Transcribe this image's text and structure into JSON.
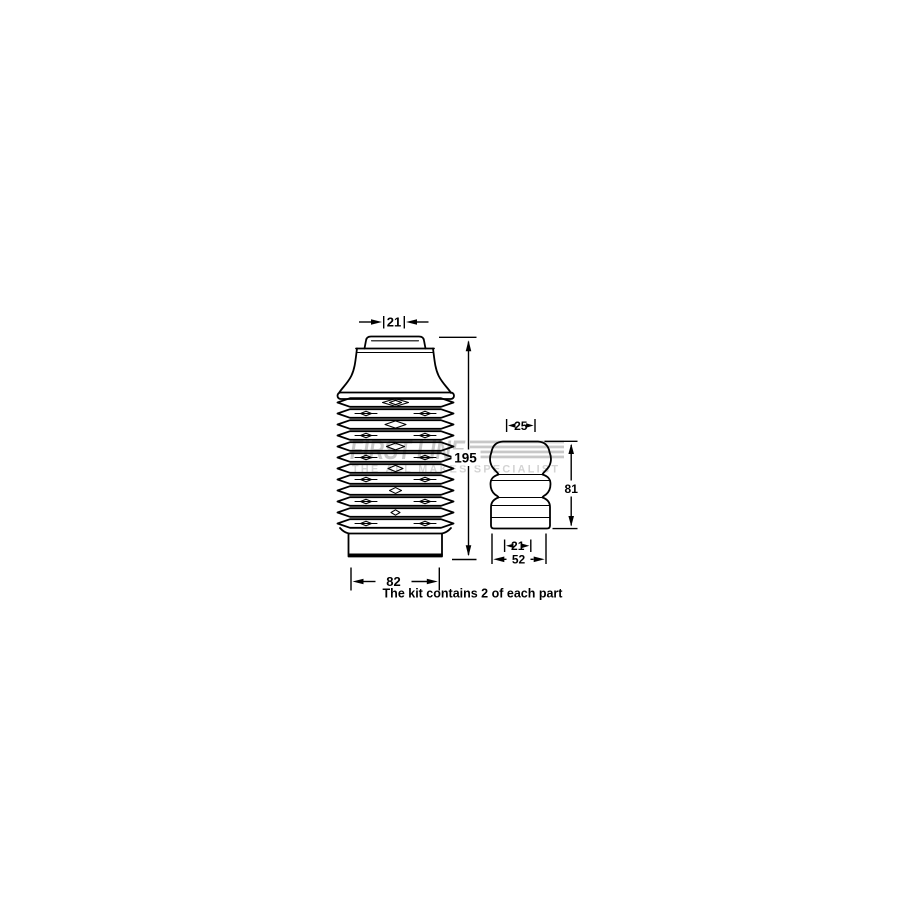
{
  "illustration": {
    "note": "The kit contains 2 of each part",
    "watermark": {
      "brand": "FIRST LINE",
      "tagline": "THE ALL MAKES SPECIALIST",
      "brand_color": "#c8c8c8",
      "tagline_color": "#d3d3d3"
    },
    "colors": {
      "line": "#000000",
      "background": "#ffffff"
    },
    "dimensions": {
      "boot_top_width": "21",
      "boot_height": "195",
      "boot_base_width": "82",
      "bump_top_width": "25",
      "bump_height": "81",
      "bump_inner_width": "21",
      "bump_base_width": "52"
    }
  }
}
